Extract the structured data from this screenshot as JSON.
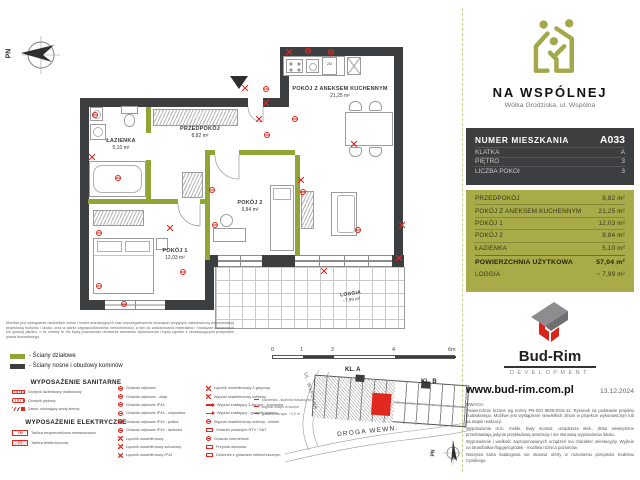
{
  "branding": {
    "estate_name": "NA WSPÓLNEJ",
    "estate_location": "Wólka Grodziska, ul. Wspólna"
  },
  "unit": {
    "header_label": "NUMER MIESZKANIA",
    "header_value": "A033",
    "rows": [
      {
        "label": "KLATKA",
        "value": "A"
      },
      {
        "label": "PIĘTRO",
        "value": "3"
      },
      {
        "label": "LICZBA POKOI",
        "value": "3"
      }
    ]
  },
  "areas": {
    "rows": [
      {
        "label": "PRZEDPOKÓJ",
        "value": "8,82 m²"
      },
      {
        "label": "POKÓJ Z ANEKSEM KUCHENNYM",
        "value": "21,25 m²"
      },
      {
        "label": "POKÓJ 1",
        "value": "12,03 m²"
      },
      {
        "label": "POKÓJ 2",
        "value": "9,84 m²"
      },
      {
        "label": "ŁAZIENKA",
        "value": "5,10 m²"
      }
    ],
    "total_label": "POWIERZCHNIA UŻYTKOWA",
    "total_value": "57,04 m²",
    "loggia_label": "LOGGIA",
    "loggia_value": "~ 7,99 m²"
  },
  "developer": {
    "name": "Bud-Rim",
    "division": "DEVELOPMENT",
    "website": "www.bud-rim.com.pl",
    "date": "13.12.2024"
  },
  "notes": {
    "title": "UWAGA:",
    "lines": [
      "Powierzchnie liczone wg normy PN-ISO 9836:2015-12. Rysunek na podstawie projektu budowlanego. Możliwe jest wystąpienie niewielkich zmian w projekcie wykonawczym lub na etapie realizacji.",
      "Wyposażenie m.in. meble, biały montaż, urządzenia elek., drzwi wewnętrzne przedstawiają jedynie przykładową aranżację i nie stanowią wyposażenia lokalu.",
      "Wyposażenie i wielkość zaproponowanych urządzeń ma charakter orientacyjny. Wyjście na taras/balkon/loggię/ogródek - możliwa różnica poziomów.",
      "Niniejsza karta katalogowa nie stanowi oferty w rozumieniu przepisów Kodeksu Cywilnego."
    ]
  },
  "plan": {
    "compass": "PN",
    "rooms": {
      "bathroom": {
        "name": "ŁAZIENKA",
        "area": "5,10 m²"
      },
      "hall": {
        "name": "PRZEDPOKÓJ",
        "area": "8,82 m²"
      },
      "living": {
        "name": "POKÓJ Z ANEKSEM KUCHENNYM",
        "area": "21,25 m²"
      },
      "room2": {
        "name": "POKÓJ 2",
        "area": "9,84 m²"
      },
      "room1": {
        "name": "POKÓJ 1",
        "area": "12,03 m²"
      },
      "loggia": {
        "name": "LOGGIA",
        "area": "~7,99 m²"
      }
    },
    "labels": {
      "dishwasher": "ZM"
    }
  },
  "legend": {
    "disclaimer": "Możliwe jest wystąpienie niewielkich zmian i korekt aranżacyjnych oraz uszczegółowienia rozwiązań przyjętych zatwierdzoną dokumentacją projektową budynku i lokalu, oraz w planie zagospodarowania nieruchomości, a tym do zastosowania materiałów i rozwiązań zamiennych nie gorszej jakości, o ile zmiany te nie będą powodować obniżenia standardu wykończenia i będą zgodne z obowiązującymi przepisami prawa budowlanego.",
    "walls": [
      "- Ściany działowe",
      "- Ściany nośne i obudowy kominów"
    ],
    "sanitary_title": "WYPOSAŻENIE SANITARNE",
    "sanitary": [
      "Grzejnik łazienkowy drabinkowy",
      "Grzejnik płytowy",
      "Zawór odcinający wody zimnej"
    ],
    "electrical_title": "WYPOSAŻENIE ELEKTRYCZNE",
    "electrical_panels": [
      {
        "symbol": "TM",
        "label": "Tablica bezpiecznikowa mieszkaniowa"
      },
      {
        "symbol": "TT",
        "label": "Tablica teletechniczna"
      }
    ],
    "electrical_col1": [
      "Gniazdo wtykowe",
      "Gniazdo wtykowe - okap",
      "Gniazdo wtykowe IP44",
      "Gniazdo wtykowe IP44 - zmywarka",
      "Gniazdo wtykowe IP44 - pralka",
      "Gniazdo wtykowe IP44 - łazienka",
      "Łącznik oświetleniowy",
      "Łącznik oświetleniowy schodowy",
      "Łącznik oświetleniowy IP44"
    ],
    "electrical_col2": [
      "Łącznik oświetleniowy 2-grupowy",
      "Wypust oświetleniowy sufitowy",
      "Wypust zasilający 3-fazowy - kuchenka",
      "Wypust zasilający - grzejnik ścienny",
      "Wypust oświetleniowy ścienny - kinkiet",
      "Gniazdo podwójne RTV / SAT",
      "Gniazdo internetowe",
      "Przycisk dzwonka",
      "Dzwonek z gniazdem teletechnicznym"
    ],
    "electrical_col3": [
      "kuchenka - kuchnia indukcyjna",
      "wypust okapu w kuchni",
      "gniazda na wys. ~2,2 m"
    ]
  },
  "scalebar": {
    "ticks": [
      "0",
      "1",
      "2",
      "4",
      "6m"
    ]
  },
  "siteplan": {
    "stair_a": "KL. A",
    "stair_b": "KL. B",
    "road": "DROGA WEWN.",
    "street": "UL. WSPÓLNA",
    "compass": "PN"
  }
}
